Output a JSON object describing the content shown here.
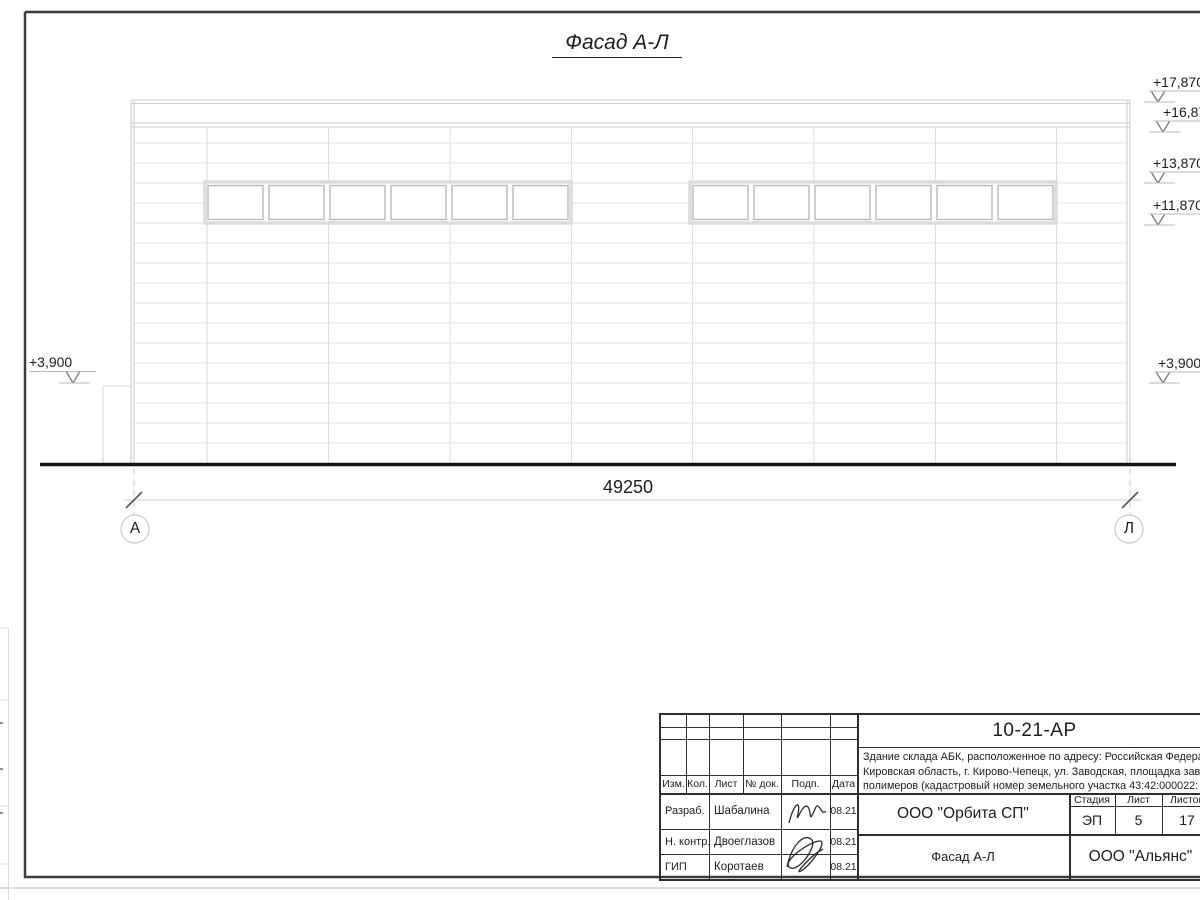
{
  "title": "Фасад А-Л",
  "dimension": {
    "total": "49250"
  },
  "axis_markers": {
    "left": "А",
    "right": "Л"
  },
  "elevation_marks": {
    "left": [
      "+3,900"
    ],
    "right": [
      "+17,870",
      "+16,870",
      "+13,870",
      "+11,870",
      "+3,900"
    ]
  },
  "title_block": {
    "doc_code": "10-21-АР",
    "project_description": {
      "line1": "Здание склада АБК, расположенное по адресу: Российская Федерац",
      "line2": "Кировская область, г. Кирово-Чепецк, ул. Заводская, площадка заво",
      "line3": "полимеров (кадастровый номер земельного участка 43:42:000022:"
    },
    "revision_headers": [
      "Изм.",
      "Кол.",
      "Лист",
      "№ док.",
      "Подп.",
      "Дата"
    ],
    "signatures": [
      {
        "role": "Разраб.",
        "name": "Шабалина",
        "date": "08.21"
      },
      {
        "role": "Н. контр.",
        "name": "Двоеглазов",
        "date": "08.21"
      },
      {
        "role": "ГИП",
        "name": "Коротаев",
        "date": "08.21"
      }
    ],
    "design_org": "ООО \"Орбита СП\"",
    "stage_label": "Стадия",
    "sheet_label": "Лист",
    "sheets_label": "Листов",
    "stage": "ЭП",
    "sheet": "5",
    "sheets": "17",
    "drawing_name": "Фасад А-Л",
    "client_org": "ООО \"Альянс\""
  },
  "colors": {
    "frame": "#3c3c3c",
    "facade_line": "#cfcfcf",
    "panel_line": "#e3e3e3",
    "window_frame": "#b9b9b9",
    "ground": "#141414",
    "text": "#1c1c1c"
  }
}
